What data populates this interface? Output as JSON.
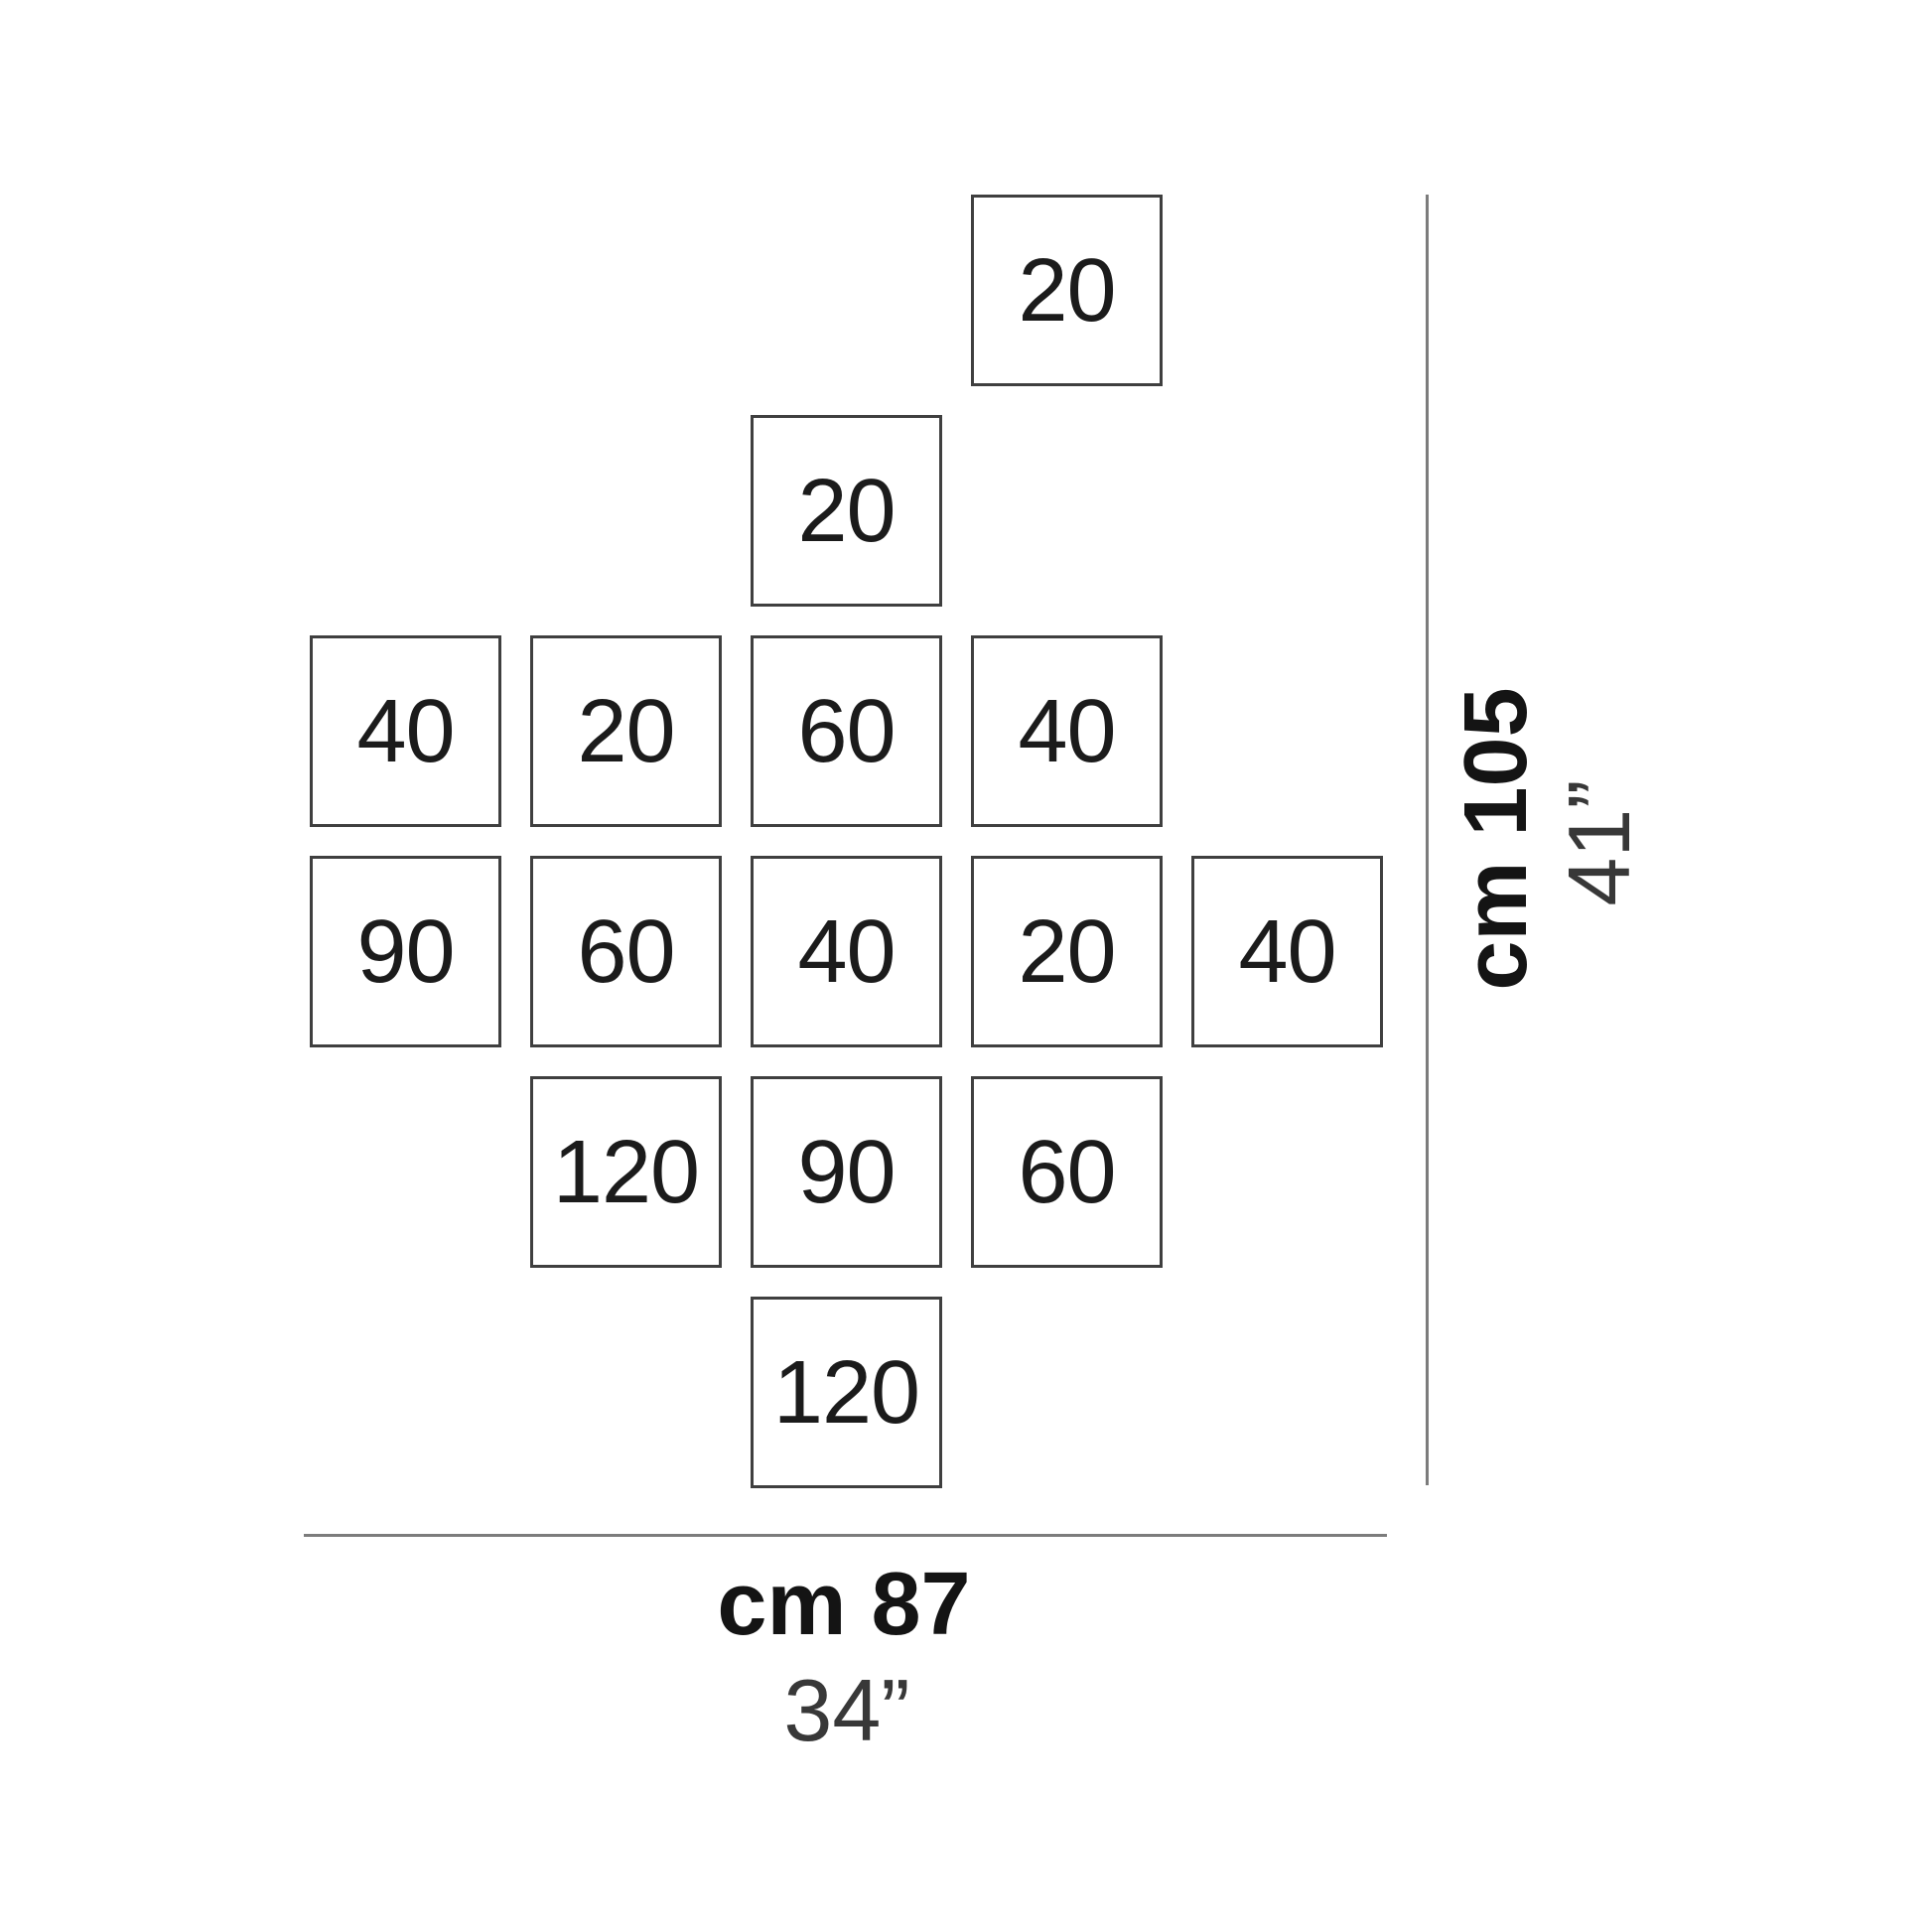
{
  "diagram": {
    "tiles": [
      {
        "label": "20"
      },
      {
        "label": "20"
      },
      {
        "label": "40"
      },
      {
        "label": "20"
      },
      {
        "label": "60"
      },
      {
        "label": "40"
      },
      {
        "label": "90"
      },
      {
        "label": "60"
      },
      {
        "label": "40"
      },
      {
        "label": "20"
      },
      {
        "label": "40"
      },
      {
        "label": "120"
      },
      {
        "label": "90"
      },
      {
        "label": "60"
      },
      {
        "label": "120"
      }
    ],
    "dimensions": {
      "height": {
        "cm_label": "cm 105",
        "inch_label": "41”"
      },
      "width": {
        "cm_label": "cm 87",
        "inch_label": "34”"
      }
    },
    "colors": {
      "tile_border": "#3f3f3f",
      "tile_number": "#1b1b1b",
      "dimension_line": "#7c7c7c",
      "cm_label": "#141414",
      "inch_label": "#383838"
    }
  }
}
